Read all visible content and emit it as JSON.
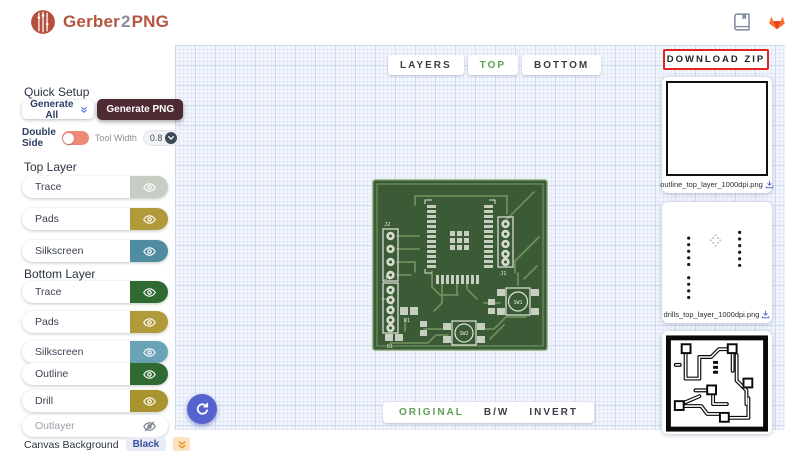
{
  "header": {
    "logo_part1": "Gerber",
    "logo_part2": "2",
    "logo_part3": "PNG"
  },
  "sidebar": {
    "quick_setup_title": "Quick Setup",
    "generate_all": "Generate All",
    "generate_png": "Generate PNG",
    "double_side": "Double Side",
    "tool_width_label": "Tool Width",
    "tool_width_value": "0.8",
    "top_layer_title": "Top Layer",
    "bottom_layer_title": "Bottom Layer",
    "layers": {
      "top": [
        {
          "label": "Trace",
          "color": "#c6cdc2"
        },
        {
          "label": "Pads",
          "color": "#b19a3a"
        },
        {
          "label": "Silkscreen",
          "color": "#4f8ca1"
        }
      ],
      "bottom": [
        {
          "label": "Trace",
          "color": "#2e6a32"
        },
        {
          "label": "Pads",
          "color": "#b19a3a"
        },
        {
          "label": "Silkscreen",
          "color": "#69a3b5"
        }
      ],
      "extra": [
        {
          "label": "Outline",
          "color": "#2e6a32"
        },
        {
          "label": "Drill",
          "color": "#a9932f"
        },
        {
          "label": "Outlayer",
          "color": ""
        }
      ]
    },
    "canvas_background_label": "Canvas Background",
    "canvas_background_value": "Black"
  },
  "canvas": {
    "view_tabs": [
      {
        "label": "LAYERS"
      },
      {
        "label": "TOP"
      },
      {
        "label": "BOTTOM"
      }
    ],
    "active_view_tab": "TOP",
    "render_tabs": [
      {
        "label": "ORIGINAL"
      },
      {
        "label": "B/W"
      },
      {
        "label": "INVERT"
      }
    ],
    "active_render_tab": "ORIGINAL",
    "pcb_labels": {
      "j1": "J1",
      "j2": "J2",
      "j4": "J4",
      "sw1": "SW1",
      "sw2": "SW2",
      "r1": "R1",
      "d1": "D1"
    }
  },
  "downloads": {
    "zip_button": "DOWNLOAD ZIP",
    "files": [
      {
        "name": "outline_top_layer_1000dpi.png"
      },
      {
        "name": "drills_top_layer_1000dpi.png"
      },
      {
        "name": ""
      }
    ]
  },
  "colors": {
    "brand_red": "#b5543f",
    "generate_png_bg": "#4e2a33",
    "accent_blue": "#4a6ee0",
    "toggle_salmon": "#ef8a78",
    "tab_active_green": "#5f9e53",
    "download_zip_border": "#e02420",
    "pcb_board_green": "#3b5a36",
    "pcb_trace_green": "#6d8f5a",
    "pcb_pad_gray": "#c9cfc0",
    "canvas_grid_blue": "#ccd9f0"
  }
}
